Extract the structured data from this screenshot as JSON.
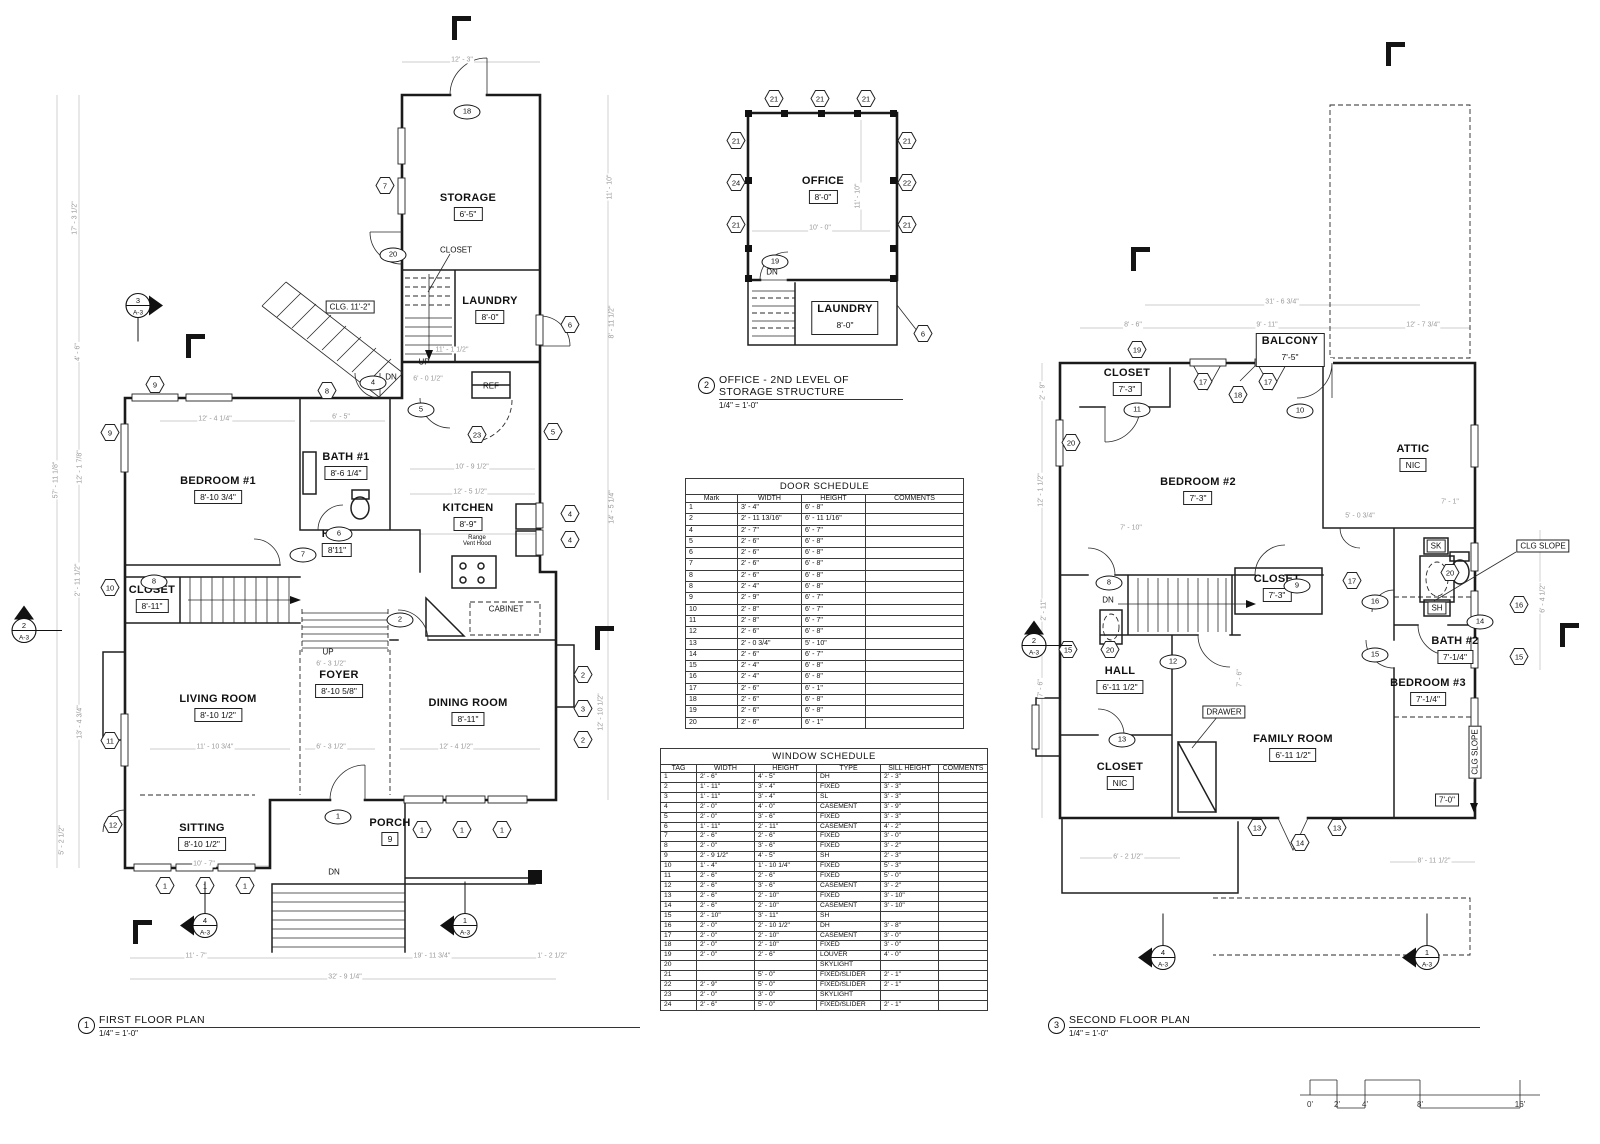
{
  "colors": {
    "wall": "#1a1a1a",
    "dim_text": "#9a9a9a",
    "background": "#ffffff"
  },
  "titles": [
    {
      "num": "1",
      "name": "FIRST FLOOR PLAN",
      "scale": "1/4\" = 1'-0\"",
      "x": 78,
      "y": 1014,
      "w": 562
    },
    {
      "num": "2",
      "name": "OFFICE - 2ND LEVEL OF STORAGE STRUCTURE",
      "scale": "1/4\" = 1'-0\"",
      "x": 698,
      "y": 374,
      "w": 205
    },
    {
      "num": "3",
      "name": "SECOND FLOOR PLAN",
      "scale": "1/4\" = 1'-0\"",
      "x": 1048,
      "y": 1014,
      "w": 432
    }
  ],
  "door_schedule": {
    "title": "DOOR SCHEDULE",
    "x": 685,
    "y": 478,
    "w": 278,
    "headers": [
      "Mark",
      "WIDTH",
      "HEIGHT",
      "COMMENTS"
    ],
    "widths": [
      52,
      64,
      64,
      98
    ],
    "rows": [
      [
        "1",
        "3' - 4\"",
        "6' - 8\"",
        ""
      ],
      [
        "2",
        "2' - 11 13/16\"",
        "6' - 11 1/16\"",
        ""
      ],
      [
        "4",
        "2' - 7\"",
        "6' - 7\"",
        ""
      ],
      [
        "5",
        "2' - 6\"",
        "6' - 8\"",
        ""
      ],
      [
        "6",
        "2' - 6\"",
        "6' - 8\"",
        ""
      ],
      [
        "7",
        "2' - 6\"",
        "6' - 8\"",
        ""
      ],
      [
        "8",
        "2' - 6\"",
        "6' - 8\"",
        ""
      ],
      [
        "8",
        "2' - 4\"",
        "6' - 8\"",
        ""
      ],
      [
        "9",
        "2' - 9\"",
        "6' - 7\"",
        ""
      ],
      [
        "10",
        "2' - 8\"",
        "6' - 7\"",
        ""
      ],
      [
        "11",
        "2' - 8\"",
        "6' - 7\"",
        ""
      ],
      [
        "12",
        "2' - 6\"",
        "6' - 8\"",
        ""
      ],
      [
        "13",
        "2' - 0 3/4\"",
        "5' - 10\"",
        ""
      ],
      [
        "14",
        "2' - 6\"",
        "6' - 7\"",
        ""
      ],
      [
        "15",
        "2' - 4\"",
        "6' - 8\"",
        ""
      ],
      [
        "16",
        "2' - 4\"",
        "6' - 8\"",
        ""
      ],
      [
        "17",
        "2' - 6\"",
        "6' - 1\"",
        ""
      ],
      [
        "18",
        "2' - 6\"",
        "6' - 8\"",
        ""
      ],
      [
        "19",
        "2' - 6\"",
        "6' - 8\"",
        ""
      ],
      [
        "20",
        "2' - 6\"",
        "6' - 1\"",
        ""
      ]
    ]
  },
  "window_schedule": {
    "title": "WINDOW SCHEDULE",
    "x": 660,
    "y": 748,
    "w": 327,
    "headers": [
      "TAG",
      "WIDTH",
      "HEIGHT",
      "TYPE",
      "SILL HEIGHT",
      "COMMENTS"
    ],
    "widths": [
      36,
      58,
      62,
      64,
      58,
      49
    ],
    "rows": [
      [
        "1",
        "2' - 6\"",
        "4' - 5\"",
        "DH",
        "2' - 3\"",
        ""
      ],
      [
        "2",
        "1' - 11\"",
        "3' - 4\"",
        "FIXED",
        "3' - 3\"",
        ""
      ],
      [
        "3",
        "1' - 11\"",
        "3' - 4\"",
        "SL",
        "3' - 3\"",
        ""
      ],
      [
        "4",
        "2' - 0\"",
        "4' - 0\"",
        "CASEMENT",
        "3' - 9\"",
        ""
      ],
      [
        "5",
        "2' - 0\"",
        "3' - 6\"",
        "FIXED",
        "3' - 3\"",
        ""
      ],
      [
        "6",
        "1' - 11\"",
        "2' - 11\"",
        "CASEMENT",
        "4' - 2\"",
        ""
      ],
      [
        "7",
        "2' - 6\"",
        "2' - 6\"",
        "FIXED",
        "3' - 0\"",
        ""
      ],
      [
        "8",
        "2' - 0\"",
        "3' - 6\"",
        "FIXED",
        "3' - 2\"",
        ""
      ],
      [
        "9",
        "2' - 9 1/2\"",
        "4' - 5\"",
        "SH",
        "2' - 3\"",
        ""
      ],
      [
        "10",
        "1' - 4\"",
        "1' - 10 1/4\"",
        "FIXED",
        "5' - 3\"",
        ""
      ],
      [
        "11",
        "2' - 6\"",
        "2' - 6\"",
        "FIXED",
        "5' - 0\"",
        ""
      ],
      [
        "12",
        "2' - 6\"",
        "3' - 6\"",
        "CASEMENT",
        "3' - 2\"",
        ""
      ],
      [
        "13",
        "2' - 6\"",
        "2' - 10\"",
        "FIXED",
        "3' - 10\"",
        ""
      ],
      [
        "14",
        "2' - 6\"",
        "2' - 10\"",
        "CASEMENT",
        "3' - 10\"",
        ""
      ],
      [
        "15",
        "2' - 10\"",
        "3' - 11\"",
        "SH",
        "",
        ""
      ],
      [
        "16",
        "2' - 0\"",
        "2' - 10 1/2\"",
        "DH",
        "3' - 8\"",
        ""
      ],
      [
        "17",
        "2' - 0\"",
        "2' - 10\"",
        "CASEMENT",
        "3' - 0\"",
        ""
      ],
      [
        "18",
        "2' - 0\"",
        "2' - 10\"",
        "FIXED",
        "3' - 0\"",
        ""
      ],
      [
        "19",
        "2' - 0\"",
        "2' - 6\"",
        "LOUVER",
        "4' - 0\"",
        ""
      ],
      [
        "20",
        "",
        "",
        "SKYLIGHT",
        "",
        ""
      ],
      [
        "21",
        "",
        "5' - 0\"",
        "FIXED/SLIDER",
        "2' - 1\"",
        ""
      ],
      [
        "22",
        "2' - 9\"",
        "5' - 0\"",
        "FIXED/SLIDER",
        "2' - 1\"",
        ""
      ],
      [
        "23",
        "2' - 0\"",
        "3' - 0\"",
        "SKYLIGHT",
        "",
        ""
      ],
      [
        "24",
        "2' - 6\"",
        "5' - 0\"",
        "FIXED/SLIDER",
        "2' - 1\"",
        ""
      ]
    ]
  },
  "rooms": [
    {
      "n": "STORAGE",
      "d": "6'-5\"",
      "x": 468,
      "y": 207
    },
    {
      "n": "LAUNDRY",
      "d": "8'-0\"",
      "x": 490,
      "y": 310
    },
    {
      "n": "BATH #1",
      "d": "8'-6 1/4\"",
      "x": 346,
      "y": 466
    },
    {
      "n": "BEDROOM #1",
      "d": "8'-10 3/4\"",
      "x": 218,
      "y": 490
    },
    {
      "n": "KITCHEN",
      "d": "8'-9\"",
      "x": 468,
      "y": 517
    },
    {
      "n": "HALL",
      "d": "8'11\"",
      "x": 337,
      "y": 543
    },
    {
      "n": "CLOSET",
      "d": "8'-11\"",
      "x": 152,
      "y": 599
    },
    {
      "n": "FOYER",
      "d": "8'-10 5/8\"",
      "x": 339,
      "y": 684
    },
    {
      "n": "LIVING ROOM",
      "d": "8'-10 1/2\"",
      "x": 218,
      "y": 708
    },
    {
      "n": "DINING ROOM",
      "d": "8'-11\"",
      "x": 468,
      "y": 712
    },
    {
      "n": "SITTING",
      "d": "8'-10 1/2\"",
      "x": 202,
      "y": 837
    },
    {
      "n": "PORCH",
      "d": "9",
      "x": 390,
      "y": 832
    },
    {
      "n": "OFFICE",
      "d": "8'-0\"",
      "x": 823,
      "y": 190
    },
    {
      "n": "LAUNDRY",
      "d": "8'-0\"",
      "x": 845,
      "y": 318,
      "boxed": true
    },
    {
      "n": "CLOSET",
      "d": "7'-3\"",
      "x": 1127,
      "y": 382
    },
    {
      "n": "BALCONY",
      "d": "7'-5\"",
      "x": 1290,
      "y": 350,
      "boxed": true
    },
    {
      "n": "BEDROOM #2",
      "d": "7'-3\"",
      "x": 1198,
      "y": 491
    },
    {
      "n": "ATTIC",
      "d": "NIC",
      "x": 1413,
      "y": 458
    },
    {
      "n": "CLOSET",
      "d": "7'-3\"",
      "x": 1277,
      "y": 588
    },
    {
      "n": "HALL",
      "d": "6'-11 1/2\"",
      "x": 1120,
      "y": 680
    },
    {
      "n": "CLOSET",
      "d": "NIC",
      "x": 1120,
      "y": 776
    },
    {
      "n": "FAMILY ROOM",
      "d": "6'-11 1/2\"",
      "x": 1293,
      "y": 748
    },
    {
      "n": "BATH #2",
      "d": "7'-1/4\"",
      "x": 1455,
      "y": 650
    },
    {
      "n": "BEDROOM #3",
      "d": "7'-1/4\"",
      "x": 1428,
      "y": 692
    }
  ],
  "notes": [
    {
      "t": "CLOSET",
      "x": 456,
      "y": 250
    },
    {
      "t": "CLG. 11'-2\"",
      "x": 350,
      "y": 307,
      "box": 1
    },
    {
      "t": "UP",
      "x": 424,
      "y": 362
    },
    {
      "t": "DN",
      "x": 391,
      "y": 377
    },
    {
      "t": "REF",
      "x": 491,
      "y": 386
    },
    {
      "t": "Range\nVent Hood",
      "x": 477,
      "y": 541,
      "sz": 6
    },
    {
      "t": "CABINET",
      "x": 506,
      "y": 609
    },
    {
      "t": "UP",
      "x": 328,
      "y": 652
    },
    {
      "t": "DN",
      "x": 334,
      "y": 872
    },
    {
      "t": "DN",
      "x": 772,
      "y": 272
    },
    {
      "t": "DN",
      "x": 1108,
      "y": 600
    },
    {
      "t": "DRAWER",
      "x": 1224,
      "y": 712,
      "box": 1
    },
    {
      "t": "SK",
      "x": 1436,
      "y": 546,
      "box": 1
    },
    {
      "t": "SH",
      "x": 1437,
      "y": 608,
      "box": 1
    },
    {
      "t": "CLG SLOPE",
      "x": 1543,
      "y": 546,
      "box": 1
    },
    {
      "t": "CLG SLOPE",
      "x": 1475,
      "y": 752,
      "box": 1,
      "vert": 1
    },
    {
      "t": "7'-0\"",
      "x": 1447,
      "y": 800,
      "box": 1
    }
  ],
  "dims": [
    {
      "t": "12' - 3\"",
      "x": 462,
      "y": 60
    },
    {
      "t": "17' - 3 1/2\"",
      "x": 75,
      "y": 218,
      "v": 1
    },
    {
      "t": "57' - 11 1/8\"",
      "x": 56,
      "y": 480,
      "v": 1
    },
    {
      "t": "4' - 6\"",
      "x": 78,
      "y": 352,
      "v": 1
    },
    {
      "t": "12' - 1 7/8\"",
      "x": 80,
      "y": 467,
      "v": 1
    },
    {
      "t": "2' - 11 1/2\"",
      "x": 78,
      "y": 580,
      "v": 1
    },
    {
      "t": "13' - 4 3/4\"",
      "x": 80,
      "y": 722,
      "v": 1
    },
    {
      "t": "5' - 2 1/2\"",
      "x": 62,
      "y": 840,
      "v": 1
    },
    {
      "t": "11' - 10\"",
      "x": 610,
      "y": 187,
      "v": 1
    },
    {
      "t": "8' - 11 1/2\"",
      "x": 612,
      "y": 322,
      "v": 1
    },
    {
      "t": "14' - 5 1/4\"",
      "x": 612,
      "y": 507,
      "v": 1
    },
    {
      "t": "12' - 10 1/2\"",
      "x": 601,
      "y": 712,
      "v": 1
    },
    {
      "t": "11' - 7\"",
      "x": 196,
      "y": 956
    },
    {
      "t": "19' - 11 3/4\"",
      "x": 432,
      "y": 956
    },
    {
      "t": "1' - 2 1/2\"",
      "x": 552,
      "y": 956
    },
    {
      "t": "32' - 9 1/4\"",
      "x": 345,
      "y": 977
    },
    {
      "t": "12' - 4 1/4\"",
      "x": 215,
      "y": 419
    },
    {
      "t": "6' - 5\"",
      "x": 341,
      "y": 417
    },
    {
      "t": "11' - 1 1/2\"",
      "x": 452,
      "y": 350
    },
    {
      "t": "6' - 0 1/2\"",
      "x": 428,
      "y": 379
    },
    {
      "t": "10' - 9 1/2\"",
      "x": 472,
      "y": 467
    },
    {
      "t": "12' - 5 1/2\"",
      "x": 470,
      "y": 492
    },
    {
      "t": "11' - 10 3/4\"",
      "x": 215,
      "y": 747
    },
    {
      "t": "6' - 3 1/2\"",
      "x": 331,
      "y": 747
    },
    {
      "t": "12' - 4 1/2\"",
      "x": 456,
      "y": 747
    },
    {
      "t": "6' - 3 1/2\"",
      "x": 331,
      "y": 664
    },
    {
      "t": "10' - 7\"",
      "x": 204,
      "y": 864
    },
    {
      "t": "10' - 0\"",
      "x": 820,
      "y": 228
    },
    {
      "t": "11' - 10\"",
      "x": 858,
      "y": 196,
      "v": 1
    },
    {
      "t": "31' - 6 3/4\"",
      "x": 1282,
      "y": 302
    },
    {
      "t": "8' - 6\"",
      "x": 1133,
      "y": 325
    },
    {
      "t": "9' - 11\"",
      "x": 1267,
      "y": 325
    },
    {
      "t": "12' - 7 3/4\"",
      "x": 1423,
      "y": 325
    },
    {
      "t": "7' - 10\"",
      "x": 1131,
      "y": 528
    },
    {
      "t": "5' - 0 3/4\"",
      "x": 1360,
      "y": 516
    },
    {
      "t": "7' - 1\"",
      "x": 1450,
      "y": 502
    },
    {
      "t": "6' - 2 1/2\"",
      "x": 1128,
      "y": 857
    },
    {
      "t": "8' - 11 1/2\"",
      "x": 1434,
      "y": 861
    },
    {
      "t": "2' - 9\"",
      "x": 1043,
      "y": 391,
      "v": 1
    },
    {
      "t": "12' - 1 1/2\"",
      "x": 1041,
      "y": 490,
      "v": 1
    },
    {
      "t": "2' - 11\"",
      "x": 1044,
      "y": 610,
      "v": 1
    },
    {
      "t": "7' - 6\"",
      "x": 1041,
      "y": 688,
      "v": 1
    },
    {
      "t": "6' - 4 1/2\"",
      "x": 1543,
      "y": 598,
      "v": 1
    },
    {
      "t": "7' - 6\"",
      "x": 1240,
      "y": 678,
      "v": 1
    }
  ],
  "hex_tags": [
    {
      "n": "7",
      "x": 385,
      "y": 188
    },
    {
      "n": "9",
      "x": 155,
      "y": 387
    },
    {
      "n": "9",
      "x": 110,
      "y": 435
    },
    {
      "n": "6",
      "x": 570,
      "y": 327
    },
    {
      "n": "5",
      "x": 553,
      "y": 434
    },
    {
      "n": "23",
      "x": 477,
      "y": 437
    },
    {
      "n": "4",
      "x": 570,
      "y": 516
    },
    {
      "n": "4",
      "x": 570,
      "y": 542
    },
    {
      "n": "8",
      "x": 327,
      "y": 393
    },
    {
      "n": "10",
      "x": 110,
      "y": 590
    },
    {
      "n": "11",
      "x": 110,
      "y": 743
    },
    {
      "n": "12",
      "x": 113,
      "y": 827
    },
    {
      "n": "2",
      "x": 583,
      "y": 677
    },
    {
      "n": "3",
      "x": 583,
      "y": 711
    },
    {
      "n": "2",
      "x": 583,
      "y": 742
    },
    {
      "n": "1",
      "x": 165,
      "y": 888
    },
    {
      "n": "1",
      "x": 205,
      "y": 888
    },
    {
      "n": "1",
      "x": 245,
      "y": 888
    },
    {
      "n": "1",
      "x": 422,
      "y": 832
    },
    {
      "n": "1",
      "x": 462,
      "y": 832
    },
    {
      "n": "1",
      "x": 502,
      "y": 832
    },
    {
      "n": "21",
      "x": 774,
      "y": 101
    },
    {
      "n": "21",
      "x": 820,
      "y": 101
    },
    {
      "n": "21",
      "x": 866,
      "y": 101
    },
    {
      "n": "21",
      "x": 736,
      "y": 143
    },
    {
      "n": "24",
      "x": 736,
      "y": 185
    },
    {
      "n": "21",
      "x": 736,
      "y": 227
    },
    {
      "n": "21",
      "x": 907,
      "y": 143
    },
    {
      "n": "22",
      "x": 907,
      "y": 185
    },
    {
      "n": "21",
      "x": 907,
      "y": 227
    },
    {
      "n": "6",
      "x": 923,
      "y": 336
    },
    {
      "n": "19",
      "x": 1137,
      "y": 352
    },
    {
      "n": "17",
      "x": 1203,
      "y": 384
    },
    {
      "n": "18",
      "x": 1238,
      "y": 397
    },
    {
      "n": "17",
      "x": 1268,
      "y": 384
    },
    {
      "n": "20",
      "x": 1071,
      "y": 445
    },
    {
      "n": "20",
      "x": 1110,
      "y": 652
    },
    {
      "n": "15",
      "x": 1068,
      "y": 652
    },
    {
      "n": "17",
      "x": 1352,
      "y": 583
    },
    {
      "n": "20",
      "x": 1450,
      "y": 575
    },
    {
      "n": "16",
      "x": 1519,
      "y": 607
    },
    {
      "n": "15",
      "x": 1519,
      "y": 659
    },
    {
      "n": "13",
      "x": 1257,
      "y": 830
    },
    {
      "n": "14",
      "x": 1300,
      "y": 845
    },
    {
      "n": "13",
      "x": 1337,
      "y": 830
    }
  ],
  "oval_tags": [
    {
      "n": "18",
      "x": 467,
      "y": 112
    },
    {
      "n": "20",
      "x": 393,
      "y": 255
    },
    {
      "n": "4",
      "x": 373,
      "y": 383
    },
    {
      "n": "5",
      "x": 421,
      "y": 410
    },
    {
      "n": "6",
      "x": 339,
      "y": 534
    },
    {
      "n": "7",
      "x": 303,
      "y": 555
    },
    {
      "n": "2",
      "x": 400,
      "y": 620
    },
    {
      "n": "8",
      "x": 154,
      "y": 582
    },
    {
      "n": "1",
      "x": 338,
      "y": 817
    },
    {
      "n": "19",
      "x": 775,
      "y": 262
    },
    {
      "n": "11",
      "x": 1137,
      "y": 410
    },
    {
      "n": "10",
      "x": 1300,
      "y": 411
    },
    {
      "n": "8",
      "x": 1109,
      "y": 583
    },
    {
      "n": "9",
      "x": 1297,
      "y": 586
    },
    {
      "n": "16",
      "x": 1375,
      "y": 602
    },
    {
      "n": "12",
      "x": 1173,
      "y": 662
    },
    {
      "n": "13",
      "x": 1122,
      "y": 740
    },
    {
      "n": "15",
      "x": 1375,
      "y": 655
    },
    {
      "n": "14",
      "x": 1480,
      "y": 622
    }
  ],
  "markers": [
    {
      "n": "3",
      "s": "A-3",
      "x": 138,
      "y": 308,
      "dir": "r"
    },
    {
      "n": "2",
      "s": "A-3",
      "x": 24,
      "y": 633,
      "dir": "u"
    },
    {
      "n": "4",
      "s": "A-3",
      "x": 205,
      "y": 928,
      "dir": "l"
    },
    {
      "n": "1",
      "s": "A-3",
      "x": 465,
      "y": 928,
      "dir": "l"
    },
    {
      "n": "2",
      "s": "A-3",
      "x": 1034,
      "y": 648,
      "dir": "u"
    },
    {
      "n": "4",
      "s": "A-3",
      "x": 1163,
      "y": 960,
      "dir": "l"
    },
    {
      "n": "1",
      "s": "A-3",
      "x": 1427,
      "y": 960,
      "dir": "l"
    }
  ],
  "flags": [
    {
      "x": 452,
      "y": 16
    },
    {
      "x": 186,
      "y": 334
    },
    {
      "x": 595,
      "y": 626
    },
    {
      "x": 133,
      "y": 920
    },
    {
      "x": 1386,
      "y": 42
    },
    {
      "x": 1131,
      "y": 247
    },
    {
      "x": 1560,
      "y": 623
    }
  ],
  "scale_bar": {
    "labels": [
      {
        "t": "0'",
        "x": 1310
      },
      {
        "t": "2'",
        "x": 1337
      },
      {
        "t": "4'",
        "x": 1365
      },
      {
        "t": "8'",
        "x": 1420
      },
      {
        "t": "16'",
        "x": 1520
      }
    ],
    "y": 1100
  }
}
